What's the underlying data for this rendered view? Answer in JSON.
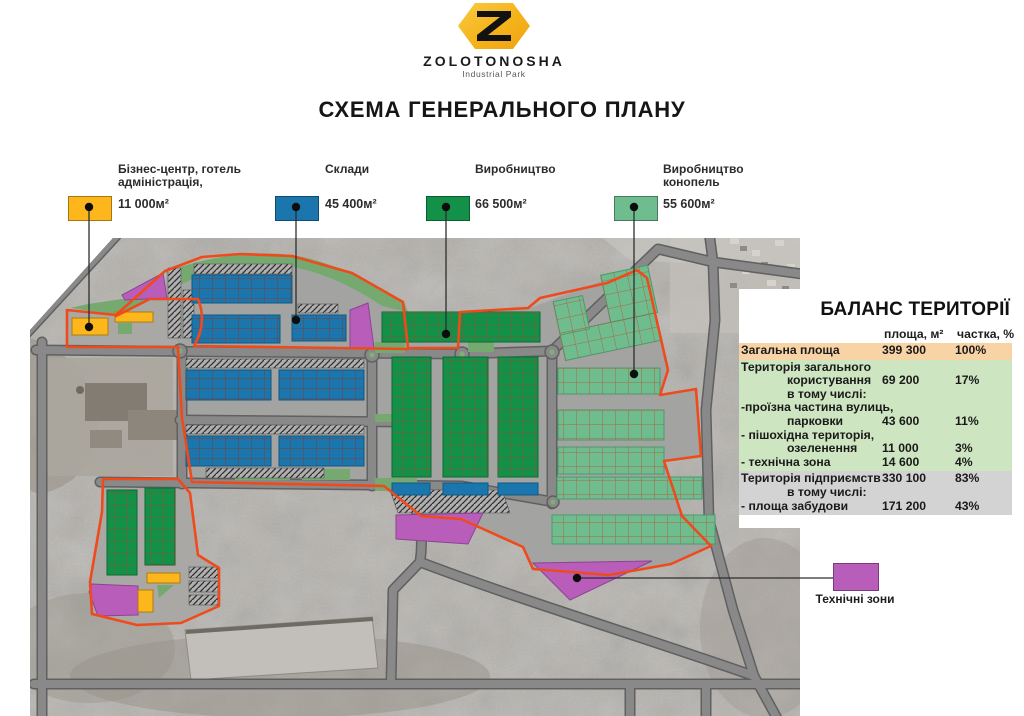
{
  "header": {
    "brand": "ZOLOTONOSHA",
    "brand_sub": "Industrial Park",
    "title": "СХЕМА ГЕНЕРАЛЬНОГО ПЛАНУ"
  },
  "legend": {
    "items": [
      {
        "line1": "Бізнес-центр, готель",
        "line2": "адміністрація,",
        "area": "11 000м²",
        "color": "#fdb71c"
      },
      {
        "line1": "Склади",
        "line2": "",
        "area": "45 400м²",
        "color": "#1b76ad"
      },
      {
        "line1": "Виробництво",
        "line2": "",
        "area": "66 500м²",
        "color": "#139149"
      },
      {
        "line1": "Виробництво",
        "line2": "конопель",
        "area": "55 600м²",
        "color": "#6fbd8e"
      }
    ],
    "tech_zone": {
      "label": "Технічні зони",
      "color": "#b95dbb"
    }
  },
  "balance_table": {
    "title": "БАЛАНС ТЕРИТОРІЇ",
    "col_area": "площа, м²",
    "col_share": "частка, %",
    "rows": [
      {
        "label": "Загальна площа",
        "area": "399 300",
        "share": "100%"
      },
      {
        "label": "Територія загального",
        "area": "",
        "share": ""
      },
      {
        "label": "користування",
        "area": "69 200",
        "share": "17%"
      },
      {
        "label": "в тому числі:",
        "area": "",
        "share": ""
      },
      {
        "label": "-проїзна частина вулиць,",
        "area": "",
        "share": ""
      },
      {
        "label": "парковки",
        "area": "43 600",
        "share": "11%"
      },
      {
        "label": "- пішохідна територія,",
        "area": "",
        "share": ""
      },
      {
        "label": "озеленення",
        "area": "11 000",
        "share": "3%"
      },
      {
        "label": "- технічна зона",
        "area": "14 600",
        "share": "4%"
      },
      {
        "label": "Територія підприємств",
        "area": "330 100",
        "share": "83%"
      },
      {
        "label": "в тому числі:",
        "area": "",
        "share": ""
      },
      {
        "label": "- площа забудови",
        "area": "171 200",
        "share": "43%"
      }
    ]
  },
  "map": {
    "colors": {
      "business_yellow": "#fdb71c",
      "warehouse_blue": "#1b76ad",
      "production_green": "#139149",
      "hemp_green": "#6fbd8e",
      "technical_purple": "#b95dbb",
      "boundary_orange": "#ef4a1c",
      "road_gray": "#898989",
      "landscape_green": "#76a970",
      "logo_gold": "#f5b31a"
    }
  }
}
